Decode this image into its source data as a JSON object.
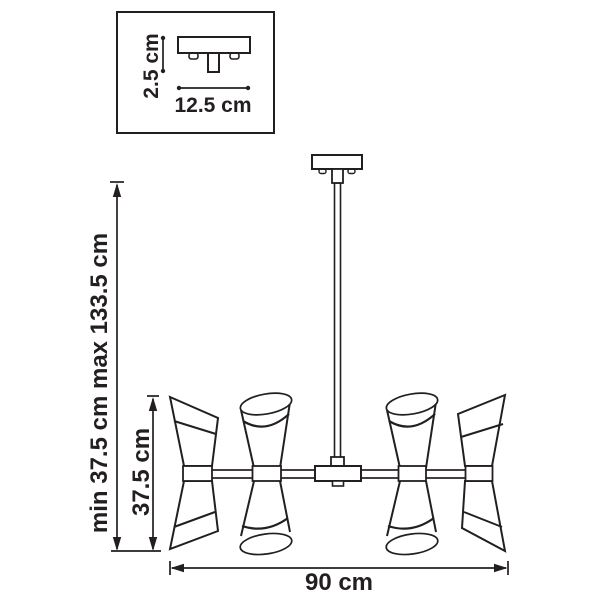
{
  "diagram": {
    "kind": "chandelier-dimension-drawing",
    "inset": {
      "depth_label": "2.5 cm",
      "width_label": "12.5 cm"
    },
    "main": {
      "overall_height_label": "min 37.5 cm max 133.5 cm",
      "body_height_label": "37.5 cm",
      "width_label": "90 cm"
    }
  },
  "colors": {
    "line": "#231f20",
    "background": "#ffffff"
  }
}
